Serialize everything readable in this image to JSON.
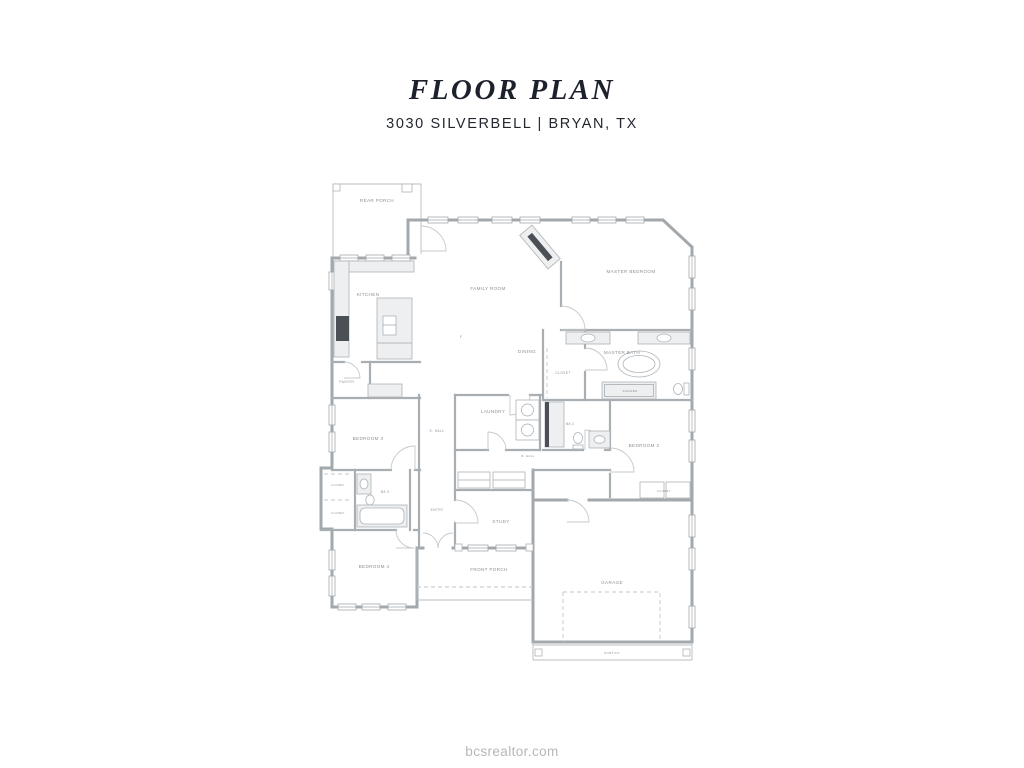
{
  "header": {
    "title": "FLOOR PLAN",
    "subtitle": "3030 SILVERBELL | BRYAN, TX"
  },
  "watermark": "bcsrealtor.com",
  "colors": {
    "title_text": "#1d212b",
    "wall": "#a2a8ac",
    "room_label": "#8b9196",
    "watermark_text": "#b4b8ba"
  },
  "plan": {
    "labels": {
      "rear_porch": "REAR PORCH",
      "kitchen": "KITCHEN",
      "pantry": "PANTRY",
      "family_room": "FAMILY ROOM",
      "dining": "DINING",
      "f_marker": "F",
      "master_bedroom": "MASTER BEDROOM",
      "master_bath": "MASTER BATH",
      "master_closet": "CLOSET",
      "shower": "SHOWER",
      "laundry": "LAUNDRY",
      "e_hall": "E. HALL",
      "b_hall": "B. HALL",
      "ba2": "BA 2",
      "bedroom2": "BEDROOM 2",
      "bedroom2_closet": "CLOSET",
      "bedroom3": "BEDROOM 3",
      "ba3": "BA 3",
      "closet_left_upper": "CLOSET",
      "closet_left_lower": "CLOSET",
      "entry": "ENTRY",
      "study": "STUDY",
      "bedroom4": "BEDROOM 4",
      "front_porch": "FRONT PORCH",
      "garage": "GARAGE",
      "portico": "PORTICO"
    }
  }
}
